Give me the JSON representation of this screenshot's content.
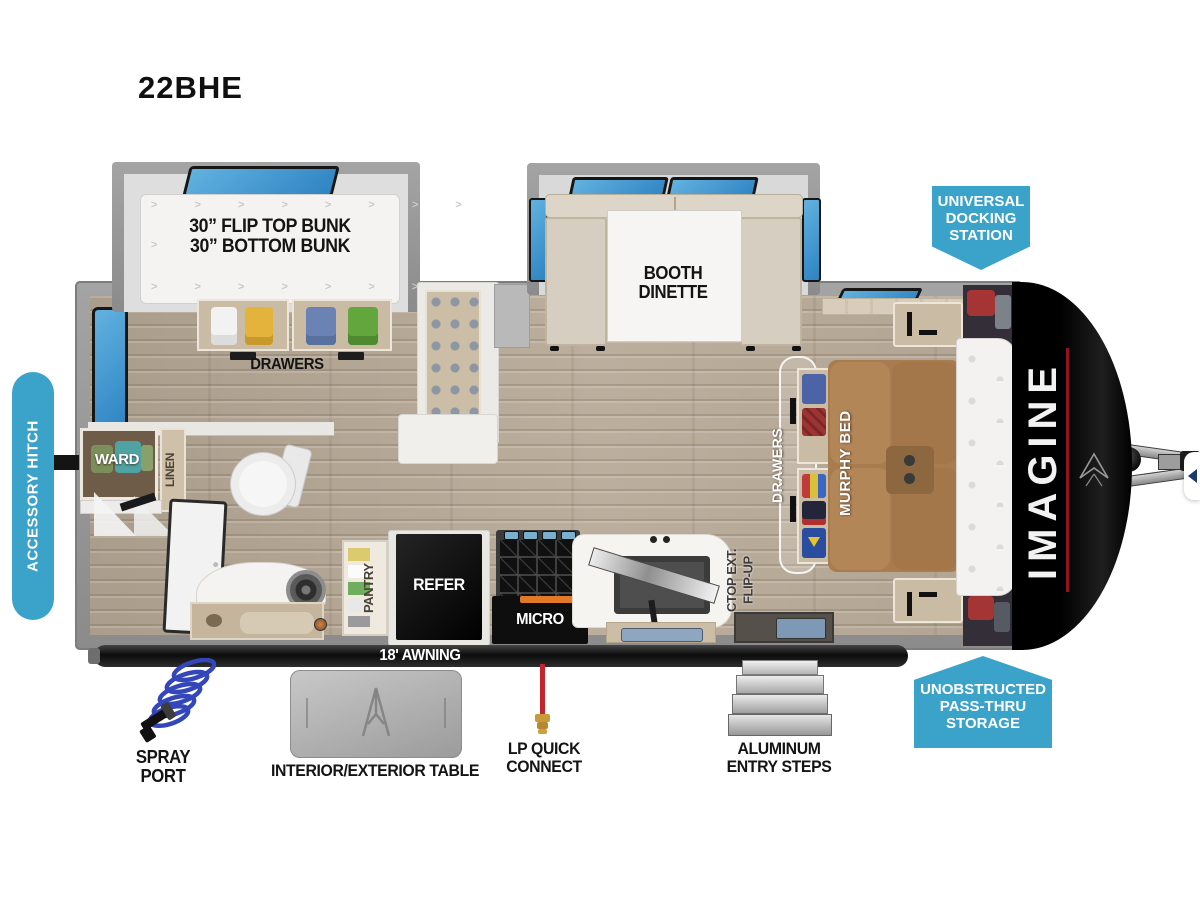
{
  "title": "22BHE",
  "brand": {
    "name": "IMAGINE"
  },
  "callouts": {
    "accessory_hitch": "ACCESSORY HITCH",
    "docking": [
      "UNIVERSAL",
      "DOCKING",
      "STATION"
    ],
    "passthru": [
      "UNOBSTRUCTED",
      "PASS-THRU",
      "STORAGE"
    ]
  },
  "interior": {
    "bunk": [
      "30” FLIP TOP BUNK",
      "30” BOTTOM BUNK"
    ],
    "bunk_drawers": "DRAWERS",
    "dinette": [
      "BOOTH",
      "DINETTE"
    ],
    "murphy_bed": "MURPHY BED",
    "murphy_drawers": "DRAWERS",
    "flip_up": [
      "FLIP-UP",
      "CTOP EXT."
    ],
    "ward": "WARD",
    "linen": "LINEN",
    "pantry": "PANTRY",
    "refer": "REFER",
    "micro": "MICRO"
  },
  "exterior": {
    "awning": "18' AWNING",
    "spray_port": [
      "SPRAY",
      "PORT"
    ],
    "table": "INTERIOR/EXTERIOR TABLE",
    "lp": [
      "LP QUICK",
      "CONNECT"
    ],
    "steps": [
      "ALUMINUM",
      "ENTRY STEPS"
    ]
  },
  "colors": {
    "callout_blue": "#3BA3C9",
    "window_blue": "#3F97CE",
    "wall_gray": "#939393",
    "floor_tan": "#B3A593",
    "bed_brown": "#A87C4E",
    "accent_red": "#8F1520",
    "appliance_black": "#141414"
  }
}
